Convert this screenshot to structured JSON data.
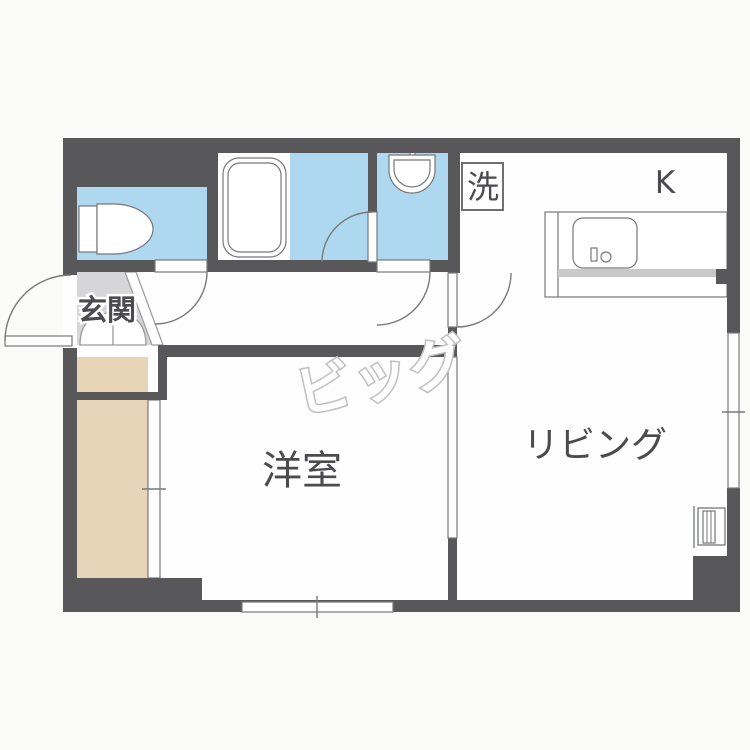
{
  "page": {
    "type": "apartment-floorplan"
  },
  "labels": {
    "entrance": "玄関",
    "western_room": "洋室",
    "living_room": "リビング",
    "laundry": "洗",
    "kitchen": "K"
  },
  "watermark": {
    "text": "ビッグ"
  },
  "colors": {
    "wall": "#58585a",
    "water": "#aed8f0",
    "closet": "#e8d5b8",
    "entrance_floor": "#d6d6d8",
    "fixture_line": "#77787a",
    "label_text": "#4b4b4d",
    "watermark": "#c0c0c0",
    "counter_shade": "#c9c9c9",
    "floor": "#fefefe",
    "background": "#fbfbfa"
  }
}
